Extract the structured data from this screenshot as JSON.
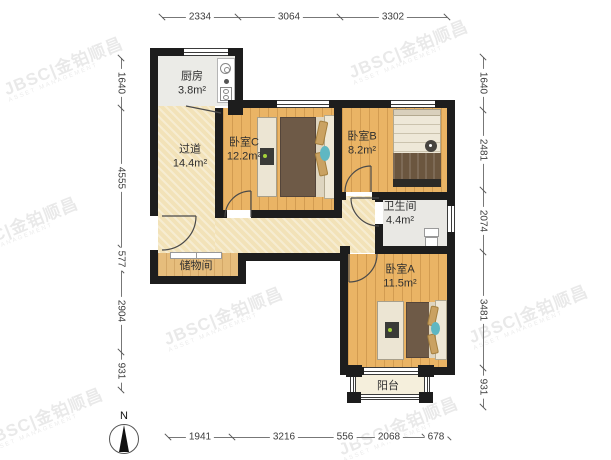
{
  "watermark": {
    "text": "JBSC|金铂顺昌",
    "sub": "ASSET MANAGEMENT"
  },
  "compass": {
    "label": "N"
  },
  "rooms": {
    "kitchen": {
      "name": "厨房",
      "area": "3.8m²"
    },
    "hallway": {
      "name": "过道",
      "area": "14.4m²"
    },
    "bedroomC": {
      "name": "卧室C",
      "area": "12.2m²"
    },
    "bedroomB": {
      "name": "卧室B",
      "area": "8.2m²"
    },
    "bathroom": {
      "name": "卫生间",
      "area": "4.4m²"
    },
    "bedroomA": {
      "name": "卧室A",
      "area": "11.5m²"
    },
    "storage": {
      "name": "储物间"
    },
    "balcony": {
      "name": "阳台"
    }
  },
  "dimensions": {
    "top": [
      "2334",
      "3064",
      "3302"
    ],
    "bottom": [
      "1941",
      "3216",
      "556",
      "2068",
      "678"
    ],
    "left": [
      "1640",
      "4555",
      "577",
      "2904",
      "931"
    ],
    "right": [
      "1640",
      "2481",
      "2074",
      "3481",
      "931"
    ]
  }
}
